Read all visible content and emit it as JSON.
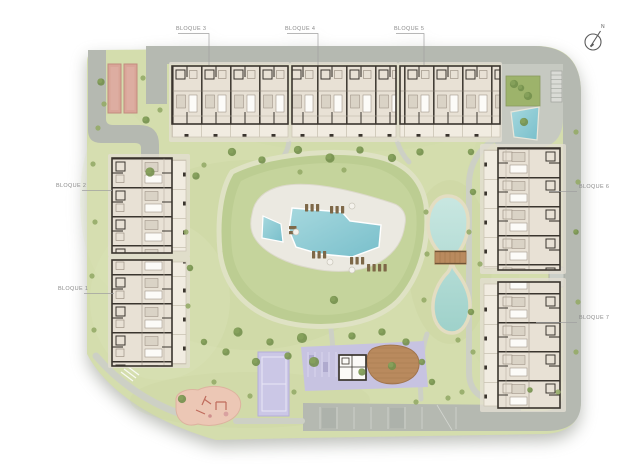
{
  "plan": {
    "type": "residential-complex-site-plan",
    "compass": {
      "label": "N"
    },
    "blocks": [
      {
        "id": "bloque-1",
        "label": "BLOQUE 1"
      },
      {
        "id": "bloque-2",
        "label": "BLOQUE 2"
      },
      {
        "id": "bloque-3",
        "label": "BLOQUE 3"
      },
      {
        "id": "bloque-4",
        "label": "BLOQUE 4"
      },
      {
        "id": "bloque-5",
        "label": "BLOQUE 5"
      },
      {
        "id": "bloque-6",
        "label": "BLOQUE 6"
      },
      {
        "id": "bloque-7",
        "label": "BLOQUE 7"
      }
    ],
    "features": [
      "central-pool",
      "kids-pool",
      "pool-deck",
      "sun-loungers",
      "umbrellas",
      "lake",
      "wooden-bridge",
      "playground",
      "paddle-court",
      "community-building",
      "wood-deck",
      "parking-area",
      "petanque-courts",
      "plaza",
      "water-feature",
      "stairs",
      "perimeter-road",
      "garden-paths",
      "trees",
      "compass"
    ]
  },
  "colors": {
    "grass": "#d4ddad",
    "grass-dark": "#c3d097",
    "mound": "#bccd92",
    "mound-inner": "#c5d49c",
    "ring": "#dfe2c4",
    "road": "#b5b9b1",
    "road-light": "#c6c9c1",
    "path": "#cdd0c5",
    "pad": "#e4dfd3",
    "building": "#e8e1d5",
    "wall": "#3a352e",
    "terrace": "#f1ece1",
    "deck": "#ebe9e1",
    "pool-light": "#a6d8de",
    "pool-dark": "#79bfcb",
    "pond-light": "#c9e7e1",
    "pond-dark": "#9ed1ca",
    "sand": "#e3ddc2",
    "purple": "#c7c3e1",
    "court": "#cbc7e6",
    "wood": "#b98a5e",
    "wood-dark": "#a1754c",
    "playground": "#ecc7b5",
    "play-equipment": "#bf6b5c",
    "red-court": "#d9a598",
    "red-court-border": "#c28b7e",
    "tree": "#74904e",
    "tree-light": "#8aa45e",
    "label": "#8b8b8b",
    "leader": "#a0a0a0",
    "compass": "#5a5a5a"
  }
}
